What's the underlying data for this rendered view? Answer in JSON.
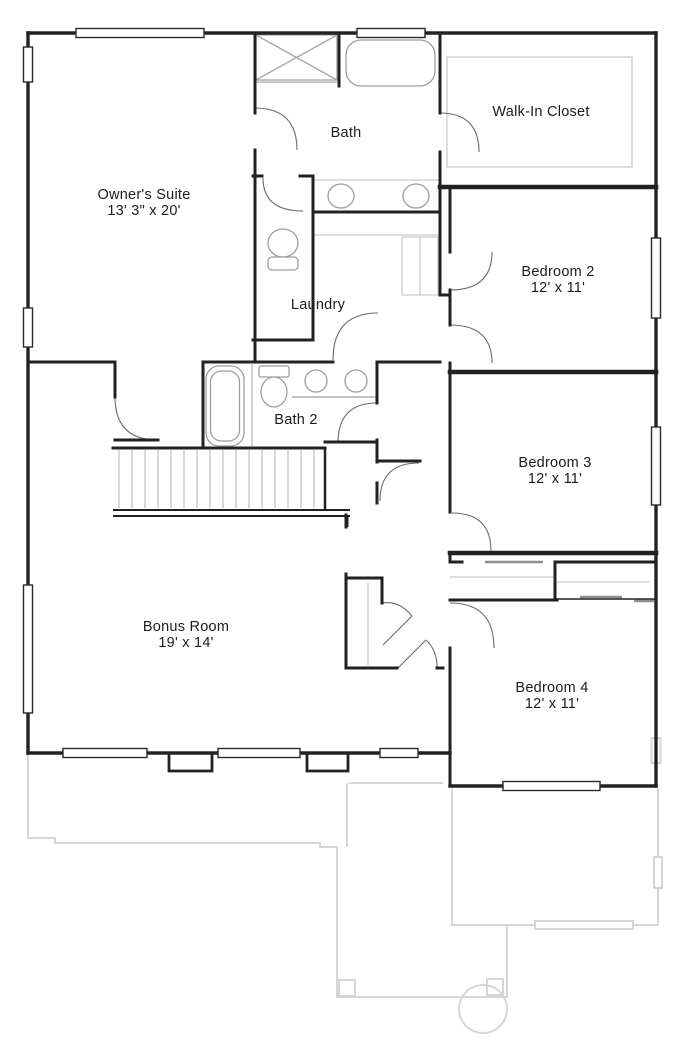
{
  "rooms": {
    "owners_suite": {
      "name": "Owner's Suite",
      "dims": "13' 3\" x 20'"
    },
    "bath": {
      "name": "Bath"
    },
    "walk_in_closet": {
      "name": "Walk-In Closet"
    },
    "laundry": {
      "name": "Laundry"
    },
    "bath2": {
      "name": "Bath 2"
    },
    "bedroom2": {
      "name": "Bedroom 2",
      "dims": "12' x 11'"
    },
    "bedroom3": {
      "name": "Bedroom 3",
      "dims": "12' x 11'"
    },
    "bedroom4": {
      "name": "Bedroom 4",
      "dims": "12' x 11'"
    },
    "bonus_room": {
      "name": "Bonus Room",
      "dims": "19' x 14'"
    }
  },
  "colors": {
    "wall": "#222222",
    "fixture": "#9e9e9e",
    "shelf_line": "#c9c9c9",
    "door_arc": "#6b6b6b",
    "ghost": "#d6d6d6",
    "stair_tread": "#bfbfbf",
    "label": "#1c1c1c"
  }
}
